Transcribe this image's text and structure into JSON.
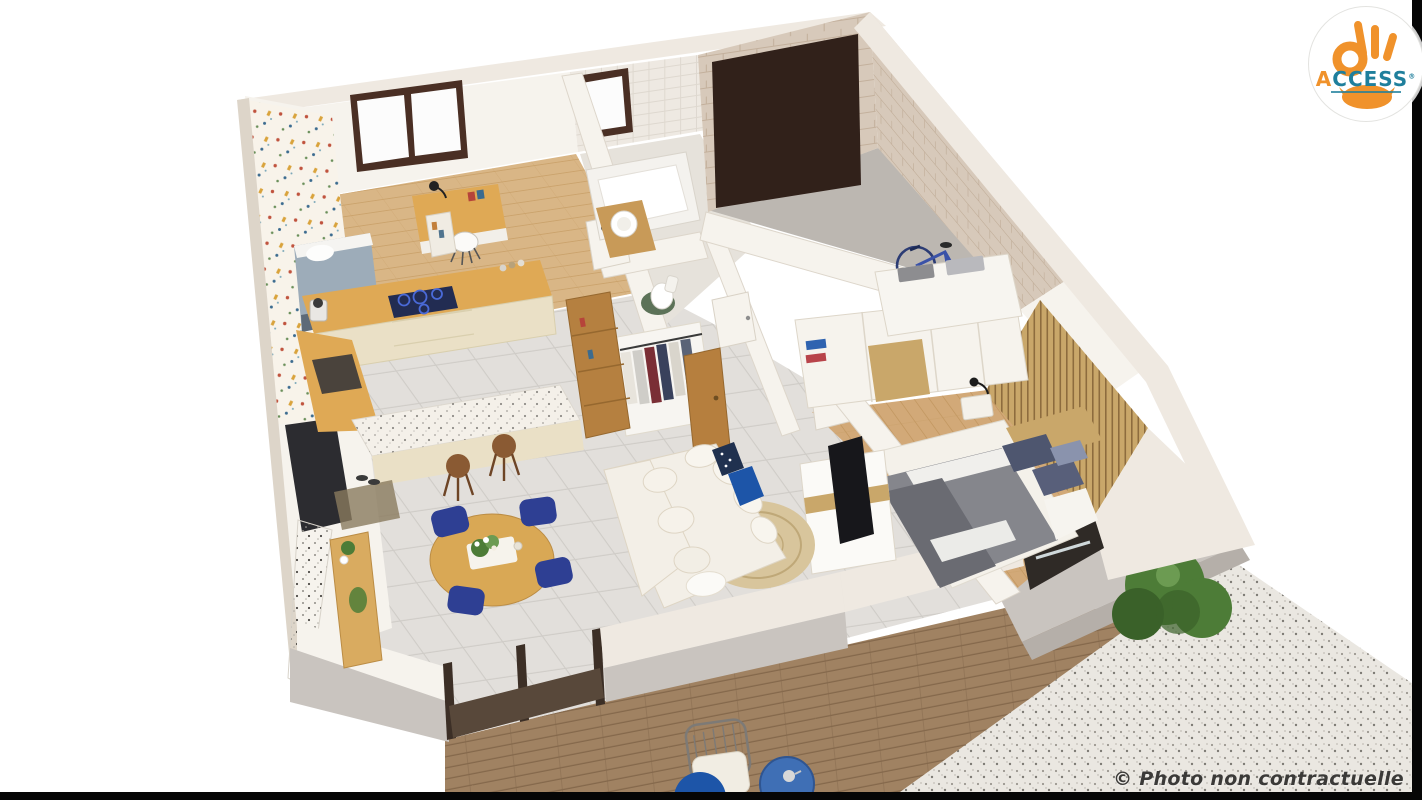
{
  "logo": {
    "letter_a": "A",
    "rest": "CCESS",
    "registered": "®"
  },
  "watermark": {
    "text": "© Photo non contractuelle"
  },
  "scene": {
    "type": "3d-floorplan-render",
    "rooms": [
      "kid-bedroom-office",
      "kitchen",
      "bathroom",
      "wc-closet",
      "garage",
      "master-bedroom",
      "living-dining",
      "terrace-deck",
      "gravel-patio"
    ]
  },
  "colors": {
    "bg": "#ffffff",
    "bar": "#060606",
    "wall-top": "#efe9e1",
    "wall-white": "#f6f3ed",
    "wall-edge": "#ddd5c9",
    "wall-grey": "#c9c4bf",
    "wall-grey-dark": "#b5afa9",
    "stone": "#d7c9ba",
    "stone-line": "#c3b09c",
    "tile-wall": "#eee9e2",
    "wallpaper": "#f8f3ea",
    "garage-door": "#31211a",
    "garage-floor": "#bcb7b1",
    "window-frame": "#4a2f24",
    "glass": "#fcfcfc",
    "frame-dark": "#3c2f26",
    "floor-wood": "#d9b686",
    "floor-wood-line": "#c79e66",
    "floor-tile": "#e2dfdb",
    "floor-tile-line": "#cfccc7",
    "deck": "#a08262",
    "deck-line": "#7f6347",
    "gravel": "#eae7e1",
    "counter-wood": "#dfa955",
    "cabinet": "#eae0c6",
    "terrazzo": "#f4f0e9",
    "cooktop": "#222c52",
    "cooktop-ring": "#4a6ad8",
    "stool": "#8a5a33",
    "table-wood": "#d9a855",
    "chair-navy": "#2e3f93",
    "sofa": "#f3efe7",
    "sofa-line": "#ded5c4",
    "pillow-blue": "#1d55a8",
    "rug": "#d8c59c",
    "rug-line": "#bfa878",
    "duvet": "#85868c",
    "duvet-dark": "#6a6b72",
    "pillow-slate": "#4e566f",
    "linen": "#f4f1ea",
    "slat": "#c9a76a",
    "slat-line": "#8d6c3e",
    "tv": "#17171b",
    "plant": "#4d7c37",
    "plant-dark": "#3a6129",
    "bed-office": "#9dacb9",
    "green-mat": "#5c7258",
    "clothes-maroon": "#7a2e35",
    "clothes-navy": "#39415c",
    "logo-orange": "#f0922b",
    "logo-teal": "#1f7f9c",
    "text-dark": "#3b3a38"
  }
}
